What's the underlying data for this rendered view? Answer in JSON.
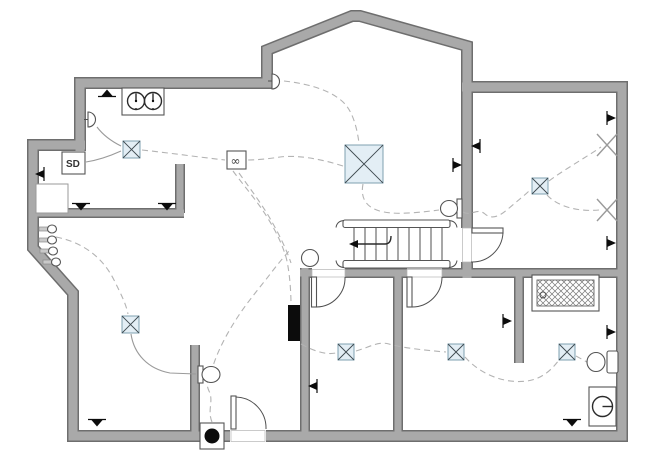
{
  "labels": {
    "smoke_detector": "SD",
    "duplex_outlet": "∞"
  },
  "colors": {
    "wall": "#a9a9a9",
    "wall_outline": "#6e6e6e",
    "fixture_fill": "#e3eef5",
    "fixture_border": "#7fa0b0",
    "fixture_cross": "#3f4a50",
    "wire_dashed": "#b3b3b3",
    "wire_solid": "#9a9a9a",
    "symbol_dark": "#0c0c0c",
    "x_mark": "#9a9a9a",
    "background": "#ffffff"
  },
  "symbols": {
    "ceiling_boxes": [
      {
        "x": 345,
        "y": 145,
        "s": 38
      },
      {
        "x": 123,
        "y": 141,
        "s": 17
      },
      {
        "x": 532,
        "y": 178,
        "s": 16
      },
      {
        "x": 122,
        "y": 316,
        "s": 17
      },
      {
        "x": 338,
        "y": 344,
        "s": 16
      },
      {
        "x": 448,
        "y": 344,
        "s": 16
      },
      {
        "x": 559,
        "y": 344,
        "s": 16
      }
    ],
    "wall_x_marks": [
      {
        "cx": 607,
        "cy": 145
      },
      {
        "cx": 607,
        "cy": 210
      }
    ],
    "receptacles": [
      {
        "cx": 107,
        "cy": 93,
        "dir": "up"
      },
      {
        "cx": 81,
        "cy": 207,
        "dir": "down"
      },
      {
        "cx": 167,
        "cy": 207,
        "dir": "down"
      },
      {
        "cx": 97,
        "cy": 423,
        "dir": "down"
      },
      {
        "cx": 572,
        "cy": 423,
        "dir": "down"
      }
    ],
    "switches": [
      {
        "cx": 39,
        "cy": 174,
        "dir": "left"
      },
      {
        "cx": 458,
        "cy": 165,
        "dir": "right"
      },
      {
        "cx": 475,
        "cy": 146,
        "dir": "left"
      },
      {
        "cx": 612,
        "cy": 118,
        "dir": "right"
      },
      {
        "cx": 612,
        "cy": 243,
        "dir": "right"
      },
      {
        "cx": 612,
        "cy": 332,
        "dir": "right"
      },
      {
        "cx": 508,
        "cy": 321,
        "dir": "right"
      },
      {
        "cx": 312,
        "cy": 386,
        "dir": "left"
      }
    ],
    "wall_hooks": [
      {
        "x": 52,
        "y": 229
      },
      {
        "x": 52,
        "y": 240
      },
      {
        "x": 53,
        "y": 251
      },
      {
        "x": 56,
        "y": 262
      }
    ]
  },
  "wiring": [
    {
      "style": "dashed",
      "d": "M 284,81 C 312,84 334,92 345,104 C 353,113 357,128 359,143"
    },
    {
      "style": "dashed",
      "d": "M 343,166 C 318,158 296,155 280,157 C 268,159 254,160 247,160"
    },
    {
      "style": "dashed",
      "d": "M 233,171 C 244,186 258,202 267,217 C 276,231 282,244 286,257 C 289,268 291,288 291,305"
    },
    {
      "style": "dashed",
      "d": "M 239,173 C 251,190 264,207 272,222 C 280,236 287,251 291,263"
    },
    {
      "style": "dashed",
      "d": "M 142,150 C 170,153 198,157 225,160"
    },
    {
      "style": "dashed",
      "d": "M 363,184 C 360,199 367,209 384,212 C 399,215 423,212 439,210"
    },
    {
      "style": "dashed",
      "d": "M 463,212 C 471,217 477,207 485,214 C 492,220 500,216 508,209 C 516,202 524,196 530,190"
    },
    {
      "style": "dashed",
      "d": "M 549,181 C 562,171 585,158 601,147"
    },
    {
      "style": "dashed",
      "d": "M 547,195 C 557,206 577,212 599,210"
    },
    {
      "style": "dashed",
      "d": "M 56,237 C 86,243 104,260 114,280 C 121,294 126,304 128,314"
    },
    {
      "style": "dashed",
      "d": "M 212,422 C 207,410 214,401 209,391 C 204,381 211,373 214,363 C 220,346 229,330 239,315 C 249,300 261,286 271,273 C 277,265 283,258 289,251"
    },
    {
      "style": "dashed",
      "d": "M 301,344 C 314,351 325,355 336,353"
    },
    {
      "style": "dashed",
      "d": "M 356,351 C 370,347 378,341 389,344 C 399,347 420,350 446,352"
    },
    {
      "style": "dashed",
      "d": "M 465,357 C 480,374 504,384 527,381 C 543,379 553,368 559,360"
    },
    {
      "style": "dashed",
      "d": "M 576,356 C 585,361 591,364 596,368"
    },
    {
      "style": "solid",
      "d": "M 131,334 C 134,354 148,369 170,373 L 196,374"
    },
    {
      "style": "solid",
      "d": "M 97,127 C 103,135 111,141 121,146"
    },
    {
      "style": "solid",
      "d": "M 86,162 C 99,160 110,156 121,151"
    }
  ]
}
